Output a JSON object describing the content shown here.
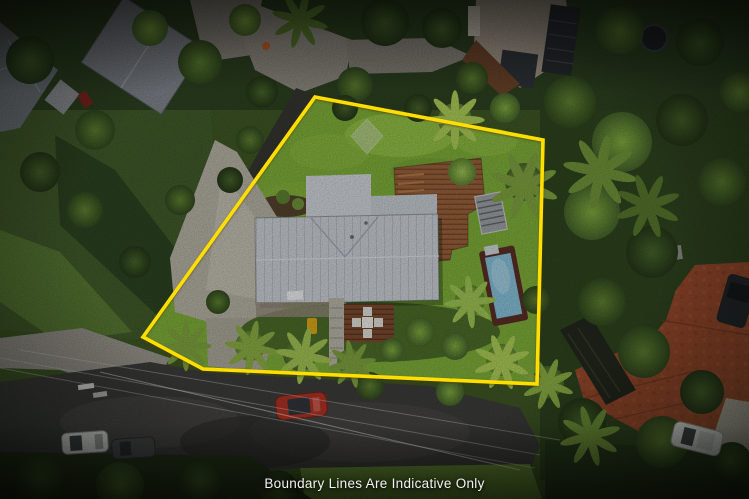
{
  "caption": {
    "text": "Boundary Lines Are Indicative Only",
    "color": "#F2F2F2"
  },
  "boundary": {
    "points": "315,97 543,140 537,384 203,369 143,337",
    "color": "#FFDE00",
    "vertices": [
      [
        315,
        97
      ],
      [
        543,
        140
      ],
      [
        537,
        384
      ],
      [
        203,
        369
      ],
      [
        143,
        337
      ]
    ]
  },
  "palette": {
    "lawn": "#7CAB38",
    "forest": "#2E431E",
    "roof": "#C7CCD2",
    "deck_wood": "#96603A",
    "pool_water": "#84BDD5",
    "pool_frame": "#5A2D26",
    "road": "#3B3B39",
    "concrete": "#B2AEA1",
    "brick_drive": "#97492B",
    "car_red": "#AA3124",
    "car_white": "#DFE0DC",
    "car_dark": "#494B4D",
    "caption_color": "#F2F2F2"
  }
}
